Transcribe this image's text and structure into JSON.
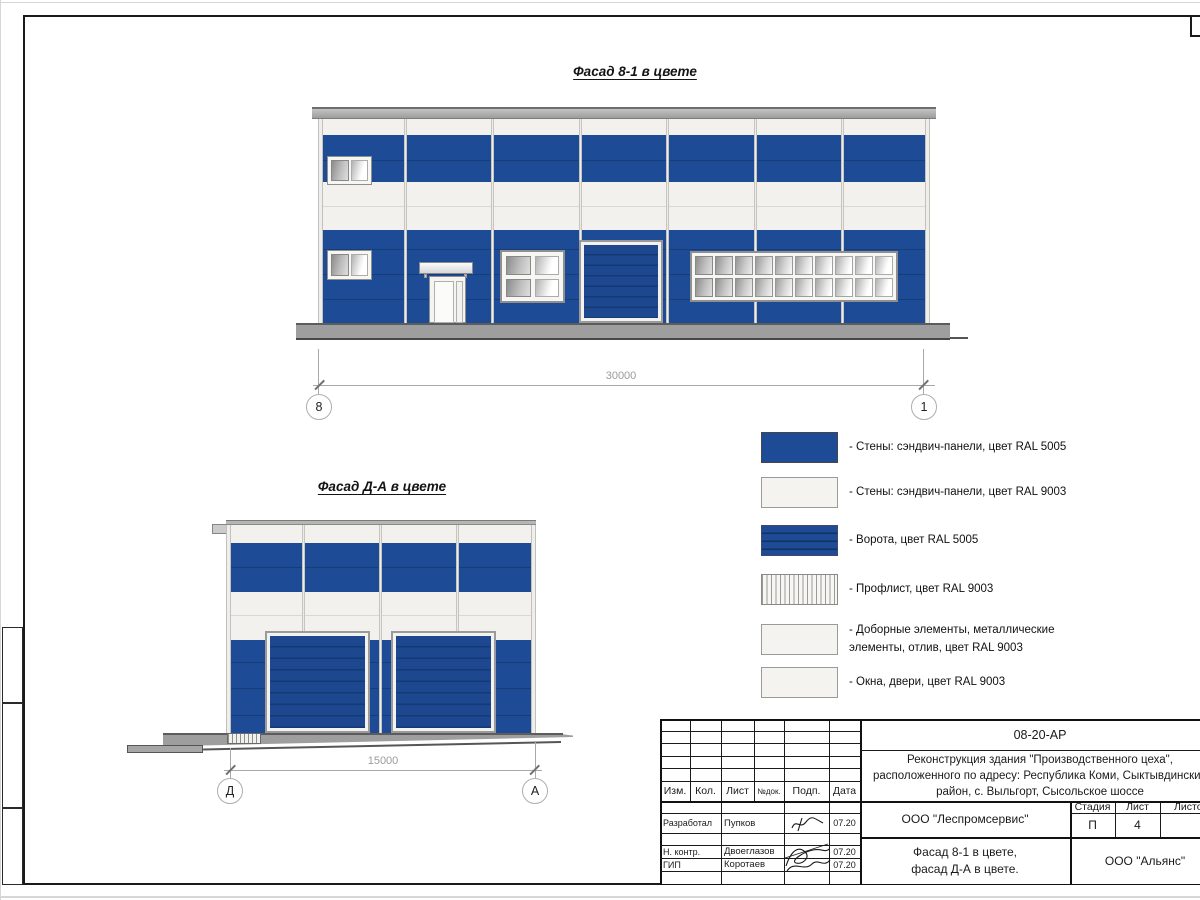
{
  "titles": {
    "facade1": "Фасад 8-1 в цвете",
    "facade2": "Фасад Д-А в цвете"
  },
  "dimensions": {
    "facade1_length": "30000",
    "facade2_length": "15000"
  },
  "axes": {
    "f1_left": "8",
    "f1_right": "1",
    "f2_left": "Д",
    "f2_right": "А"
  },
  "colors": {
    "ral5005_blue": "#1e4b96",
    "ral9003_white": "#f2f1ed"
  },
  "legend": {
    "items": [
      {
        "swatch": "wall-blue",
        "lines": [
          "- Стены: сэндвич-панели, цвет RAL 5005",
          ""
        ]
      },
      {
        "swatch": "wall-white",
        "lines": [
          "- Стены: сэндвич-панели, цвет RAL 9003",
          ""
        ]
      },
      {
        "swatch": "gate-blue",
        "lines": [
          "- Ворота, цвет RAL 5005",
          ""
        ]
      },
      {
        "swatch": "profiled-sheet",
        "lines": [
          "- Профлист, цвет RAL 9003",
          ""
        ]
      },
      {
        "swatch": "trim-white",
        "lines": [
          "- Доборные элементы, металлические",
          "элементы, отлив, цвет RAL 9003"
        ]
      },
      {
        "swatch": "windows-doors",
        "lines": [
          "- Окна, двери, цвет RAL 9003",
          ""
        ]
      }
    ]
  },
  "title_block": {
    "doc_code": "08-20-АР",
    "project_lines": [
      "Реконструкция здания \"Производственного цеха\",",
      "расположенного по адресу: Республика Коми, Сыктывдинский",
      "район, с. Выльгорт, Сысольское шоссе"
    ],
    "columns": [
      "Изм.",
      "Кол.",
      "Лист",
      "№док.",
      "Подп.",
      "Дата"
    ],
    "signature_rows": [
      {
        "role": "Разработал",
        "name": "Пупков",
        "date": "07.20"
      },
      {
        "role": "Н. контр.",
        "name": "Двоеглазов",
        "date": "07.20"
      },
      {
        "role": "ГИП",
        "name": "Коротаев",
        "date": "07.20"
      }
    ],
    "organization": "ООО \"Леспромсервис\"",
    "sheet_title_lines": [
      "Фасад 8-1 в цвете,",
      "фасад Д-А в цвете."
    ],
    "stage_label": "Стадия",
    "list_label": "Лист",
    "lists_label": "Листов",
    "stage_value": "П",
    "list_value": "4",
    "lists_value": "",
    "contractor": "ООО \"Альянс\""
  }
}
